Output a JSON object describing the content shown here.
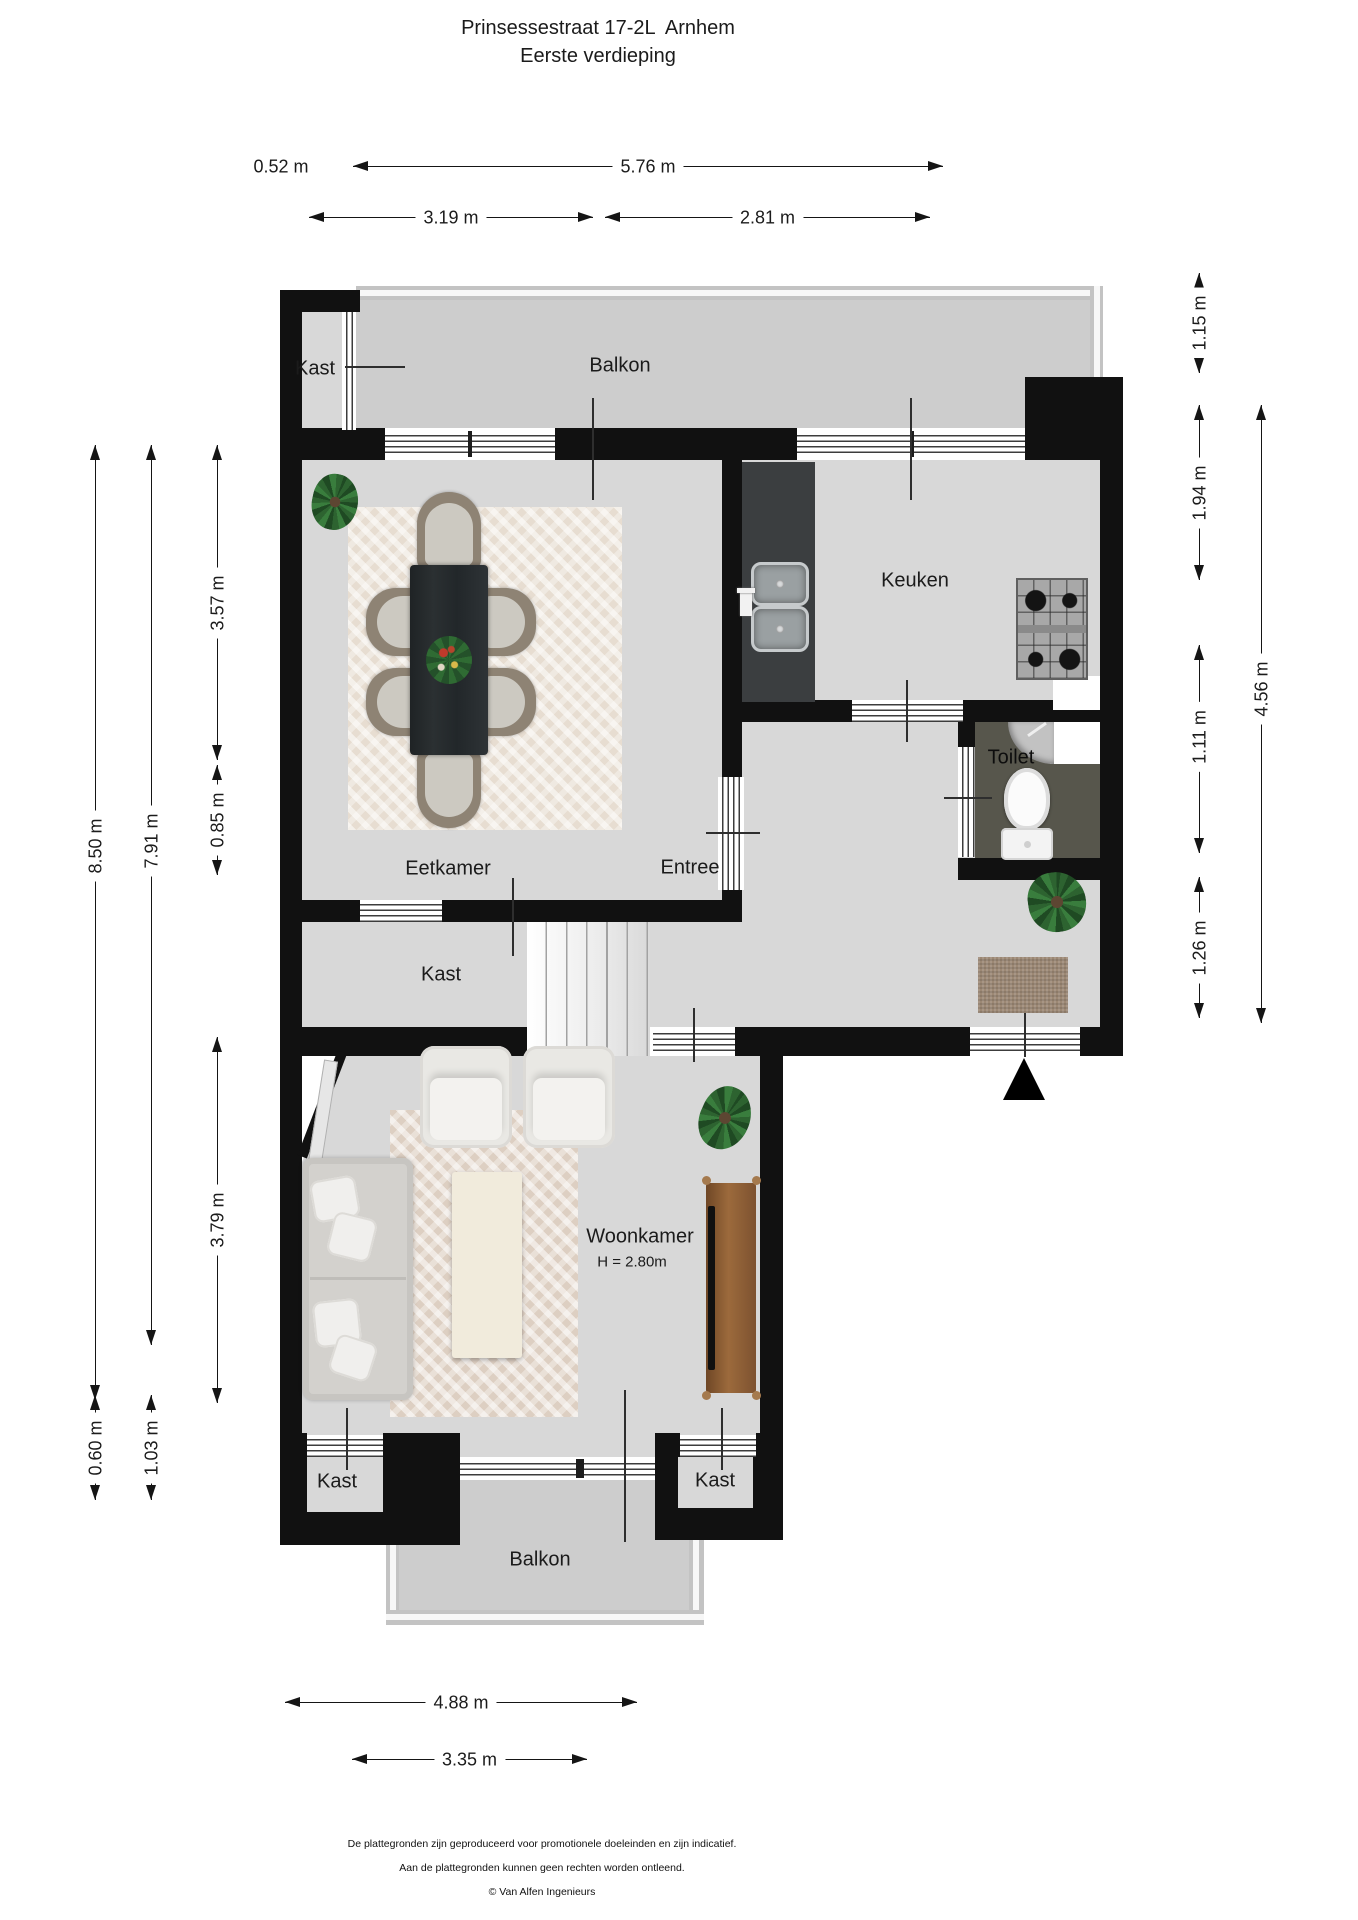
{
  "title": {
    "line1": "Prinsessestraat 17-2L  Arnhem",
    "line2": "Eerste verdieping"
  },
  "rooms": {
    "kast_top": "Kast",
    "balkon_top": "Balkon",
    "eetkamer": "Eetkamer",
    "keuken": "Keuken",
    "toilet": "Toilet",
    "entree": "Entree",
    "kast_mid": "Kast",
    "woonkamer": "Woonkamer",
    "woonkamer_height": "H = 2.80m",
    "kast_bottom_left": "Kast",
    "kast_bottom_right": "Kast",
    "balkon_bottom": "Balkon"
  },
  "dimensions": {
    "top_offset": "0.52 m",
    "top_total": "5.76 m",
    "top_left_segment": "3.19 m",
    "top_right_segment": "2.81 m",
    "left_total": "8.50 m",
    "left_inner": "7.91 m",
    "left_eetkamer": "3.57 m",
    "left_kast": "0.85 m",
    "left_woonkamer": "3.79 m",
    "left_balkon_offset": "1.03 m",
    "left_balkon_depth": "0.60 m",
    "right_balkon": "1.15 m",
    "right_keuken": "1.94 m",
    "right_toilet": "1.11 m",
    "right_entree": "1.26 m",
    "right_total": "4.56 m",
    "bottom_total": "4.88 m",
    "bottom_balkon": "3.35 m"
  },
  "footer": {
    "line1": "De plattegronden zijn geproduceerd voor promotionele doeleinden en zijn indicatief.",
    "line2": "Aan de plattegronden kunnen geen rechten worden ontleend.",
    "line3": "© Van Alfen Ingenieurs"
  },
  "colors": {
    "wall": "#111111",
    "floor": "#d8d8d8",
    "balcony_floor": "#cdcdcd",
    "toilet_floor": "#57564c",
    "window_line": "#3c3c3c",
    "wood": "#8a5c36",
    "plant_green": "#2d6330",
    "text": "#1b1b1b"
  }
}
